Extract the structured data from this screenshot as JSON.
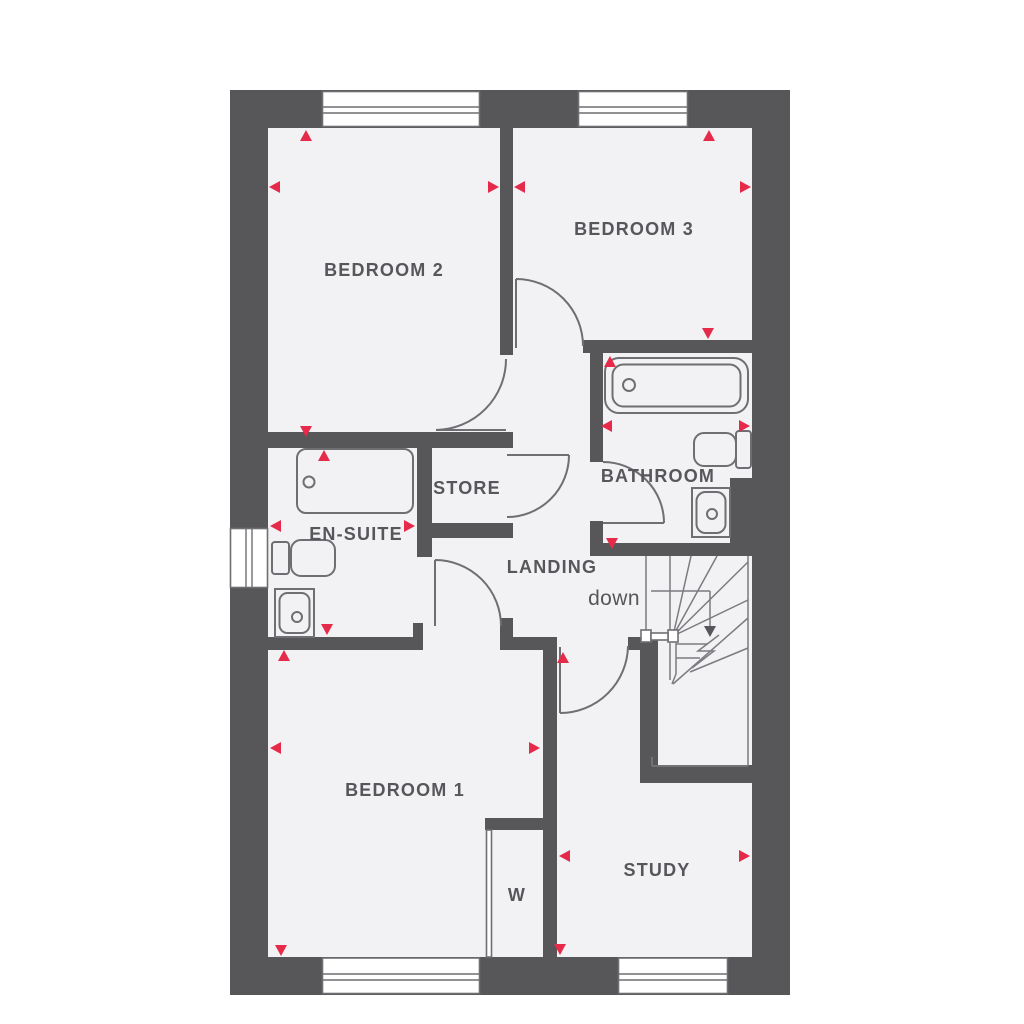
{
  "plan": {
    "rooms": {
      "bedroom2": {
        "label": "BEDROOM 2"
      },
      "bedroom3": {
        "label": "BEDROOM 3"
      },
      "bathroom": {
        "label": "BATHROOM"
      },
      "ensuite": {
        "label": "EN-SUITE"
      },
      "store": {
        "label": "STORE"
      },
      "landing": {
        "label": "LANDING"
      },
      "bedroom1": {
        "label": "BEDROOM 1"
      },
      "study": {
        "label": "STUDY"
      },
      "wardrobe": {
        "label": "W"
      }
    },
    "stairs": {
      "direction_label": "down"
    },
    "colors": {
      "wall": "#575659",
      "floor": "#f2f1f3",
      "fixture-line": "#6f6e72",
      "stair-line": "#7c7b80",
      "arrow": "#e62a4a",
      "text": "#57565a",
      "background": "#ffffff"
    }
  }
}
